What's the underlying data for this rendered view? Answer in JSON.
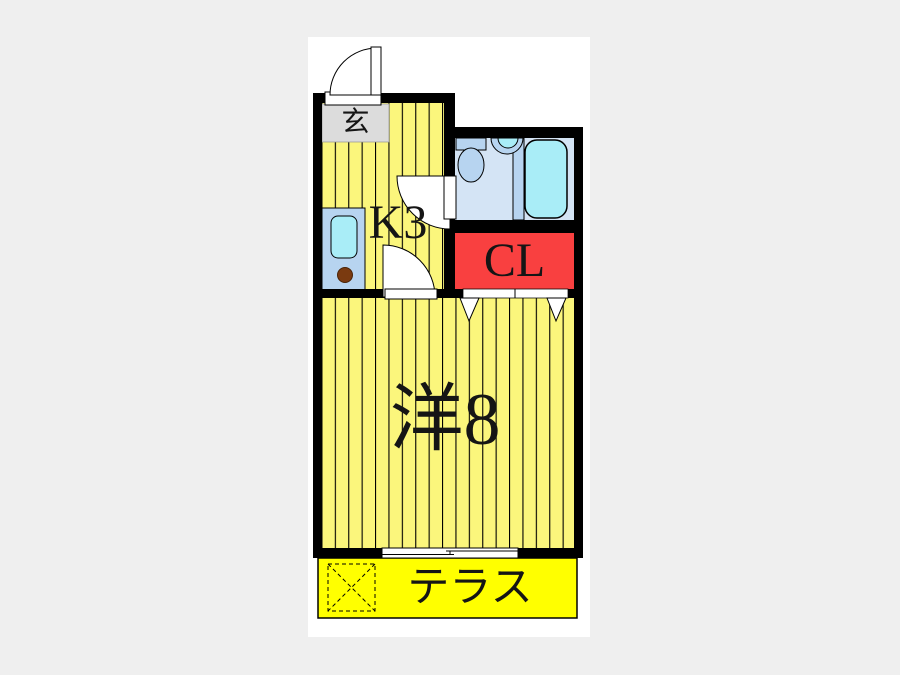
{
  "floorplan": {
    "labels": {
      "entrance": "玄",
      "kitchen": "K3",
      "closet": "CL",
      "main_room": "洋8",
      "terrace": "テラス"
    },
    "colors": {
      "background": "#EFEFEF",
      "paper": "#FFFFFF",
      "wall": "#000000",
      "room_yellow": "#FBF67C",
      "terrace_yellow": "#FFFF00",
      "closet_red": "#F94040",
      "washroom_blue": "#D4E4F5",
      "fixture_blue": "#B7D4F0",
      "water_cyan": "#A9EDF7",
      "entrance_gray": "#DCDCDC",
      "burner_brown": "#7A3A10"
    },
    "fixtures": [
      "entry-door",
      "kitchen-counter",
      "kitchen-sink",
      "stove-burner",
      "toilet",
      "wash-basin",
      "bathtub",
      "washroom-door",
      "room-door",
      "closet-sliding-doors",
      "sliding-window",
      "washer-space"
    ]
  }
}
